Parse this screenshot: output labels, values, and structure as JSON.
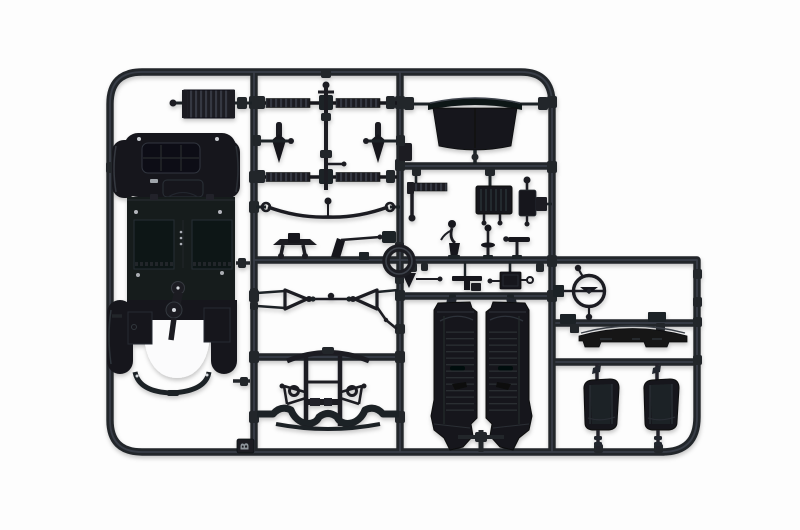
{
  "scene": {
    "type": "plastic-model-kit-sprue-photo",
    "tag_label": "B",
    "background_color": "#ffffff",
    "plastic_color": "#17181c",
    "runner_color": "#23262c",
    "runner_highlight_color": "#3d434c",
    "detail_line_color": "#2e333a",
    "white_mark_color": "#c6c9ce",
    "parts": [
      "radiator-panel-part",
      "chassis-body-part",
      "dashboard-part",
      "axle-rod-front",
      "axle-rod-rear",
      "steering-column-rod",
      "dagger-link-left",
      "dagger-link-right",
      "leaf-spring-part",
      "pedal-platform-part",
      "lever-arm-part",
      "pedal-bar-part",
      "engine-block-part",
      "canister-part",
      "rail-bracket-part",
      "gear-lever-part",
      "shift-lever-part",
      "valve-handle-part",
      "funnel-part",
      "t-bracket-part",
      "gearbox-part",
      "ring-part",
      "control-arm-left",
      "link-rod",
      "control-arm-right",
      "subframe-part",
      "valance-part",
      "door-panel-left",
      "door-panel-right",
      "steering-wheel-part",
      "cowl-panel-part",
      "seat-left",
      "seat-right",
      "sprue-tag"
    ]
  }
}
